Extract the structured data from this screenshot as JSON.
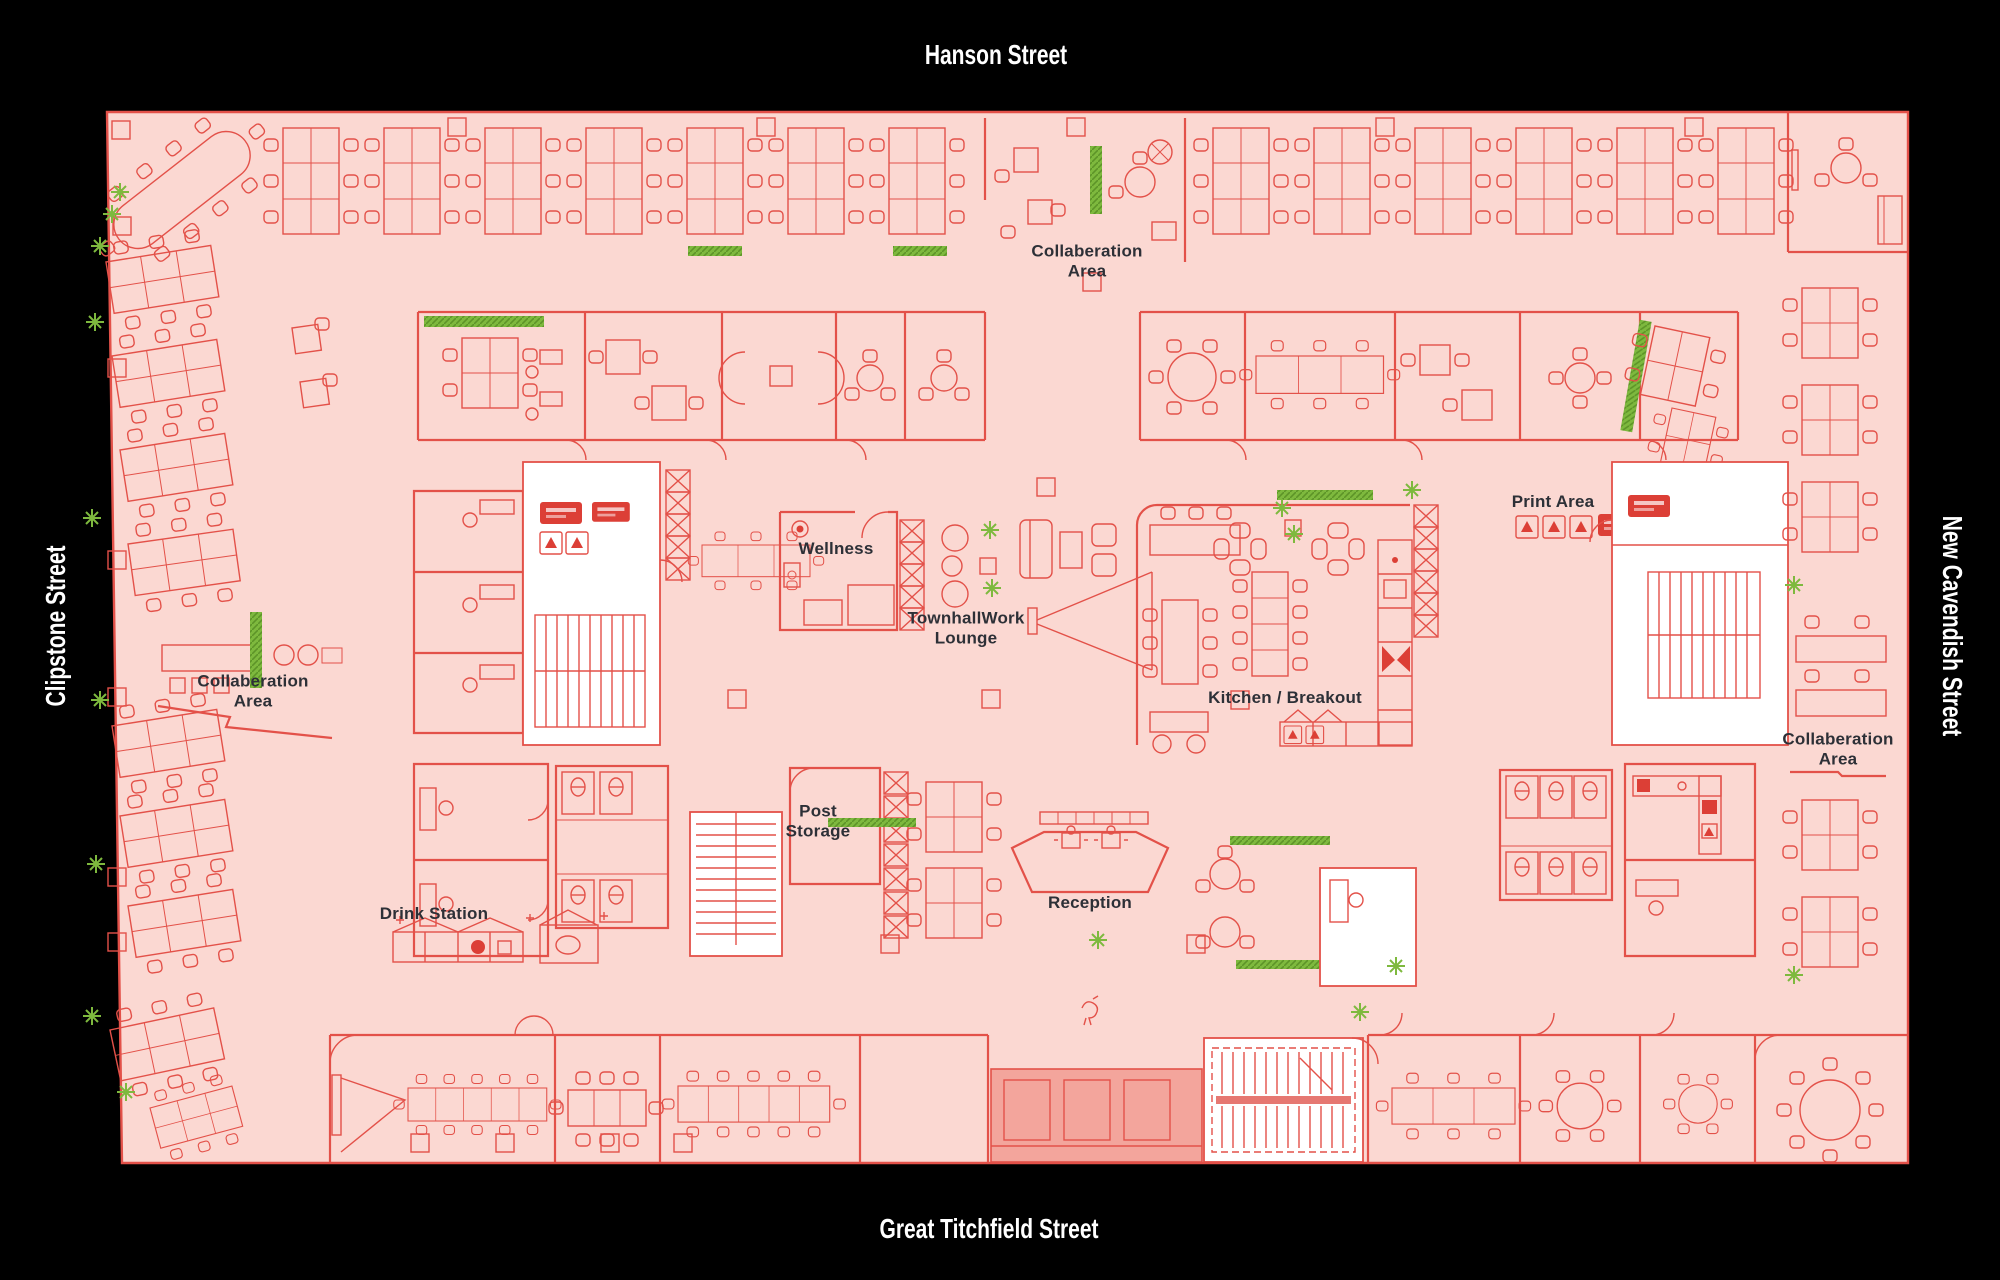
{
  "canvas": {
    "width": 2000,
    "height": 1280
  },
  "streets": {
    "top": "Hanson Street",
    "left": "Clipstone Street",
    "right": "New Cavendish Street",
    "bottom": "Great Titchfield Street"
  },
  "areas": {
    "collab_top": "Collaberation\nArea",
    "collab_left": "Collaberation\nArea",
    "collab_right": "Collaberation\nArea",
    "wellness": "Wellness",
    "townhall_lounge": "TownhallWork\nLounge",
    "print_area": "Print Area",
    "kitchen_breakout": "Kitchen / Breakout",
    "post_storage": "Post\nStorage",
    "drink_station": "Drink Station",
    "reception": "Reception"
  },
  "colors": {
    "background": "#000000",
    "plan_fill": "#fbd8d2",
    "line_red": "#e35149",
    "solid_red": "#dc3f36",
    "entrance_fill": "#f3a59c",
    "room_white": "#ffffff",
    "plant_green": "#7eb93e",
    "plant_green_dark": "#5d9428",
    "label_text": "#2d3037",
    "street_text": "#ffffff"
  }
}
